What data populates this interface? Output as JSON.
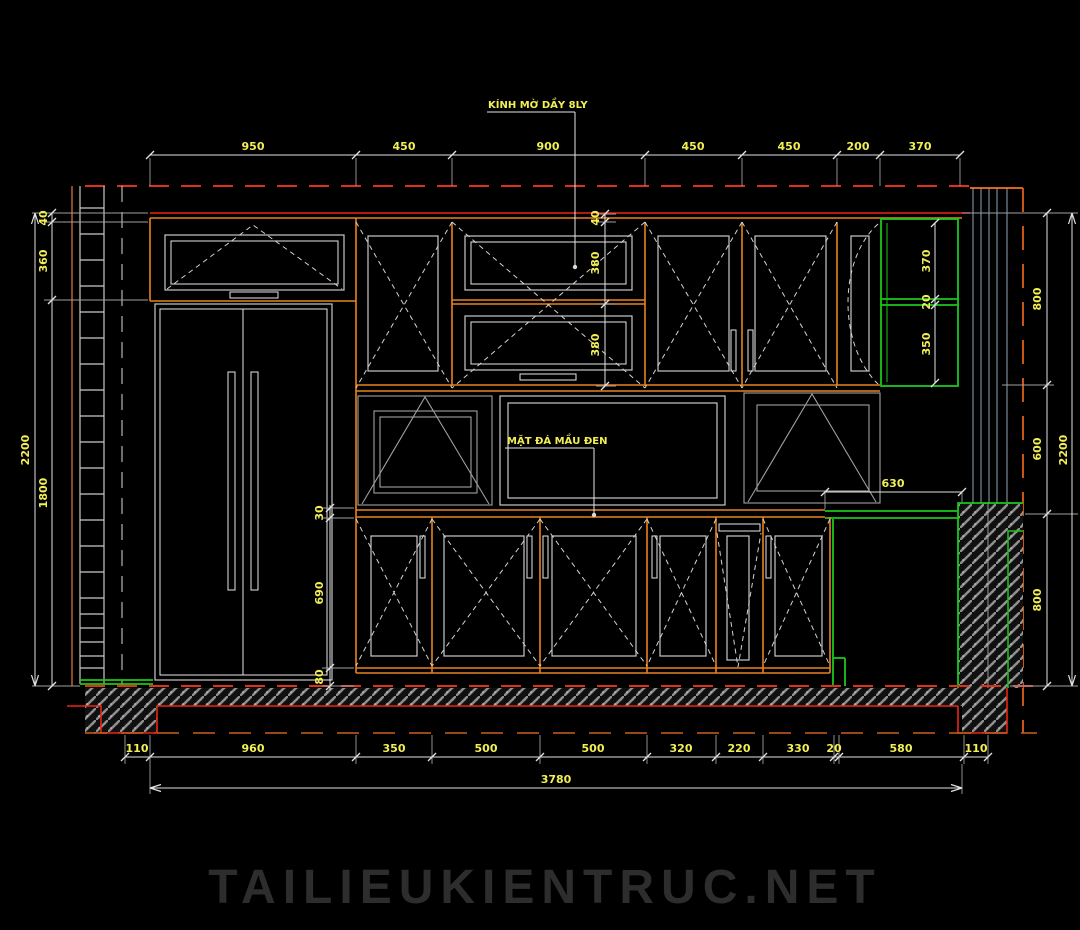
{
  "annotations": {
    "glass_note": "KÍNH MỜ DẦY 8LY",
    "stone_note": "MẶT ĐÁ MẦU ĐEN"
  },
  "dims": {
    "top": [
      "950",
      "450",
      "900",
      "450",
      "450",
      "200",
      "370"
    ],
    "bottom": [
      "110",
      "960",
      "350",
      "500",
      "500",
      "320",
      "220",
      "330",
      "20",
      "580",
      "110"
    ],
    "total_width": "3780",
    "left": [
      "40",
      "360",
      "1800",
      "2200"
    ],
    "right": [
      "800",
      "600",
      "800",
      "2200"
    ],
    "upper_cabinet": [
      "40",
      "380",
      "380"
    ],
    "shelf": [
      "370",
      "20",
      "350"
    ],
    "base": [
      "30",
      "690",
      "80"
    ],
    "counter": "630"
  },
  "watermark": "TAILIEUKIENTRUC.NET",
  "colors": {
    "background": "#000000",
    "red_line": "#ea2517",
    "orange_line": "#e8821e",
    "green_line": "#18c918",
    "yellow_text": "#f2ef55",
    "blue_gray_line": "#8fa3b8",
    "gray_line": "#c9c9c9",
    "watermark_gray": "#2d2d2d"
  }
}
